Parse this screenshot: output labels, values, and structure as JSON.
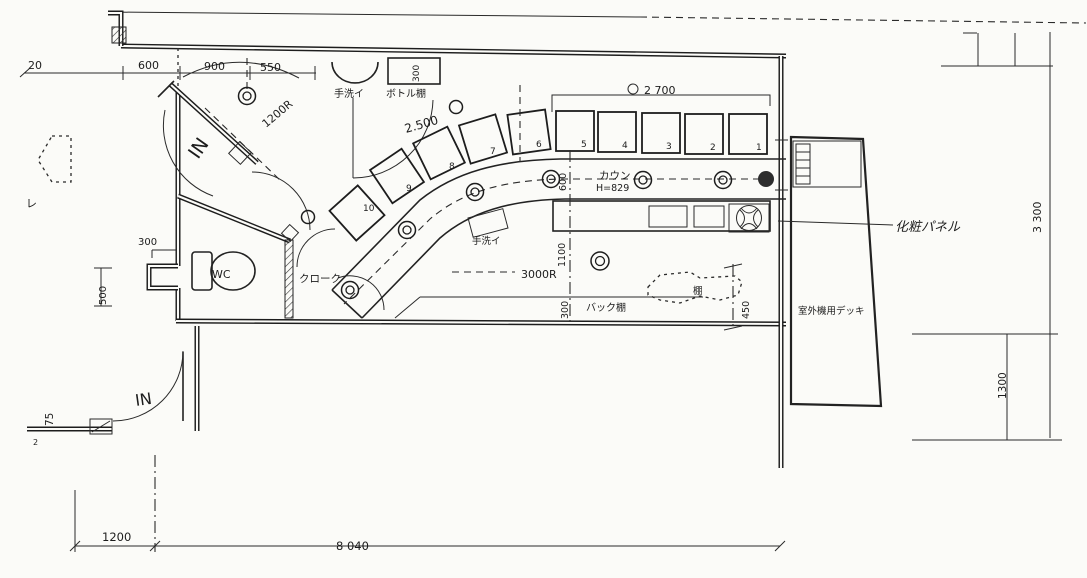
{
  "labels": {
    "in_top": "IN",
    "in_bottom": "IN",
    "handwash_top": "手洗イ",
    "bottle_shelf": "ボトル棚",
    "counter": "カウン",
    "counter_height": "H=829",
    "handwash_counter": "手洗イ",
    "cloak": "クローク",
    "wc": "WC",
    "back_shelf": "バック棚",
    "shelf": "棚",
    "makeup_panel": "化粧パネル",
    "outdoor_deck": "室外機用デッキ",
    "mark_re": "レ",
    "mark_2": "2"
  },
  "dims": {
    "d20": "20",
    "d600_top": "600",
    "d900": "900",
    "d550": "550",
    "d300_bottle": "300",
    "d2700": "2 700",
    "d2500": "2.500",
    "r1200": "1200R",
    "r3000": "3000R",
    "d600_col": "600",
    "d1100": "1100",
    "d300_col": "300",
    "d300_wc": "300",
    "d500": "500",
    "d450": "450",
    "d3300": "3 300",
    "d1300": "1300",
    "d1200_bottom": "1200",
    "d8040": "8 040",
    "d75": "75"
  },
  "seats": [
    "1",
    "2",
    "3",
    "4",
    "5",
    "6",
    "7",
    "8",
    "9",
    "10"
  ]
}
